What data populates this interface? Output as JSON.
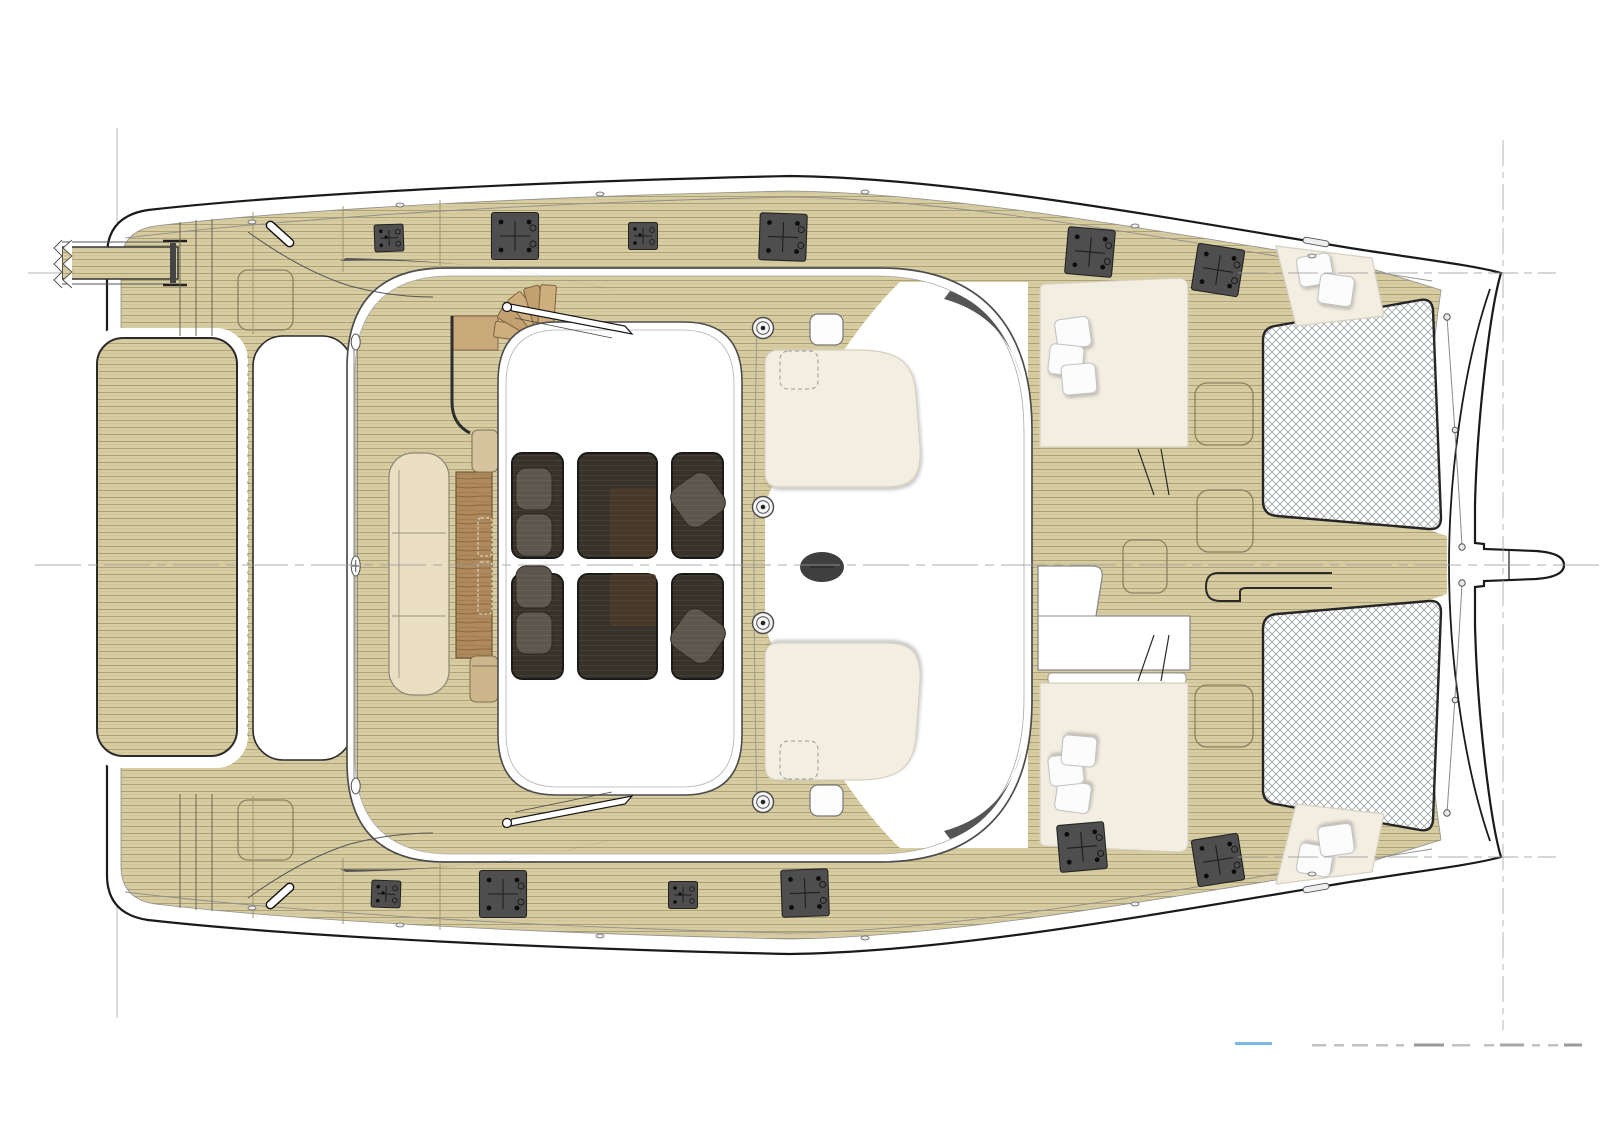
{
  "document": {
    "kind": "yacht-deck-plan",
    "description": "Top view technical deck plan of a sailing catamaran, bow pointing right",
    "visible_text": "none (only unreadable cropped text fragments at bottom right)"
  },
  "colors": {
    "paper": "#ffffff",
    "line": "#1a1a1a",
    "construction": "#b5b5b5",
    "teak_base": "#d8cda2",
    "teak_seam": "#a89c70",
    "teak_dark_edge": "#6b6552",
    "structure_edge": "#4d4d4d",
    "cream_pad": "#f3eee2",
    "pad_edge": "#d6d0c0",
    "pillow": "#fcfcfc",
    "hatch_dark": "#4e4e4e",
    "window_dark": "#38332a",
    "window_frame": "#1b1915",
    "furniture_dark": "#5c564c",
    "wood_table": "#b08a5c",
    "wood_step": "#c9a87a",
    "mast": "#3f3f3f",
    "net_line": "#9aa0a4",
    "accent_blue": "#7db9e8",
    "remnant_gray": "#c2c2c2",
    "crescent": "#555555",
    "sofa": "#eadfc3"
  },
  "inventory": {
    "skylight_windows": 6,
    "armchairs_visible_through_skylight": 6,
    "deck_hatches_large": 8,
    "deck_hatches_small": 4,
    "winches": 4,
    "trampolines": 2,
    "sunpads": 4,
    "helm_pads": 2,
    "sunpad_pillows": 10,
    "deck_lockers": 6,
    "staircase_steps": 5,
    "sofa_sections": 3,
    "cleats": 2,
    "grab_rails": 2,
    "passerelle": 1,
    "bowsprit": 1,
    "aft_platform": 1,
    "mast_base": 1
  },
  "watermark_fragments": {
    "blue_underline_color": "#7db9e8",
    "gray_fragment_color": "#c2c2c2",
    "readable": false
  }
}
